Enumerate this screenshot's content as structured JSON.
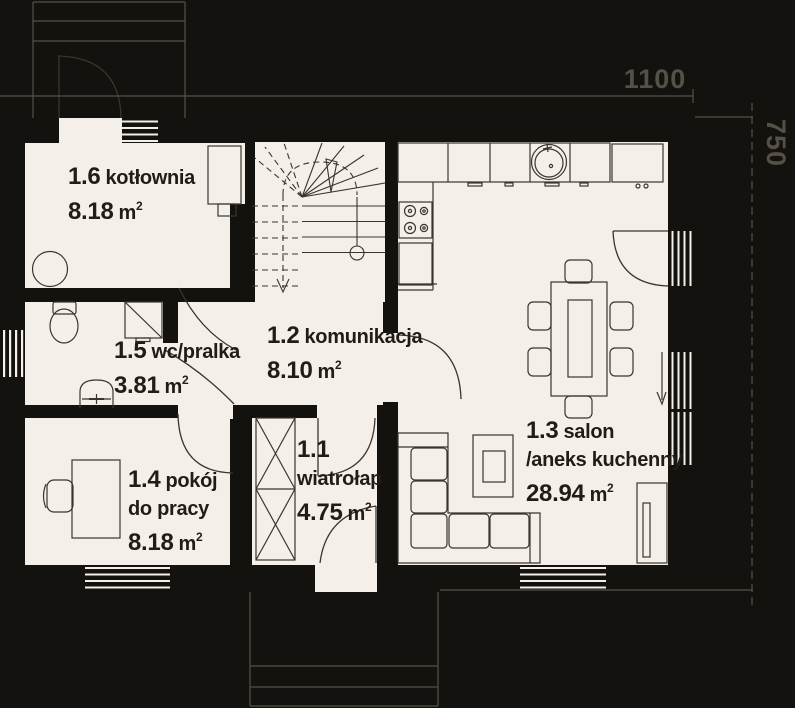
{
  "plan_title": "parter floor plan",
  "annotations": {
    "width_dim": "1100",
    "height_dim": "750"
  },
  "units": {
    "area_unit": "m",
    "area_sup": "2"
  },
  "rooms": {
    "kotlownia": {
      "id": "1.6",
      "name": "kotłownia",
      "area": "8.18"
    },
    "wc": {
      "id": "1.5",
      "name": "wc/pralka",
      "area": "3.81"
    },
    "komunikacja": {
      "id": "1.2",
      "name": "komunikacja",
      "area": "8.10"
    },
    "wiatrolap": {
      "id": "1.1",
      "name": "wiatrołap",
      "area": "4.75"
    },
    "pokoj": {
      "id": "1.4",
      "name": "pokój",
      "name2": "do pracy",
      "area": "8.18"
    },
    "salon": {
      "id": "1.3",
      "name": "salon",
      "name2": "/aneks kuchenny",
      "area": "28.94"
    }
  },
  "colors": {
    "background": "#14120e",
    "floor": "#f4efe8",
    "furniture_line": "#3a352d",
    "label_ink": "#201d17",
    "annotation": "#565047"
  }
}
